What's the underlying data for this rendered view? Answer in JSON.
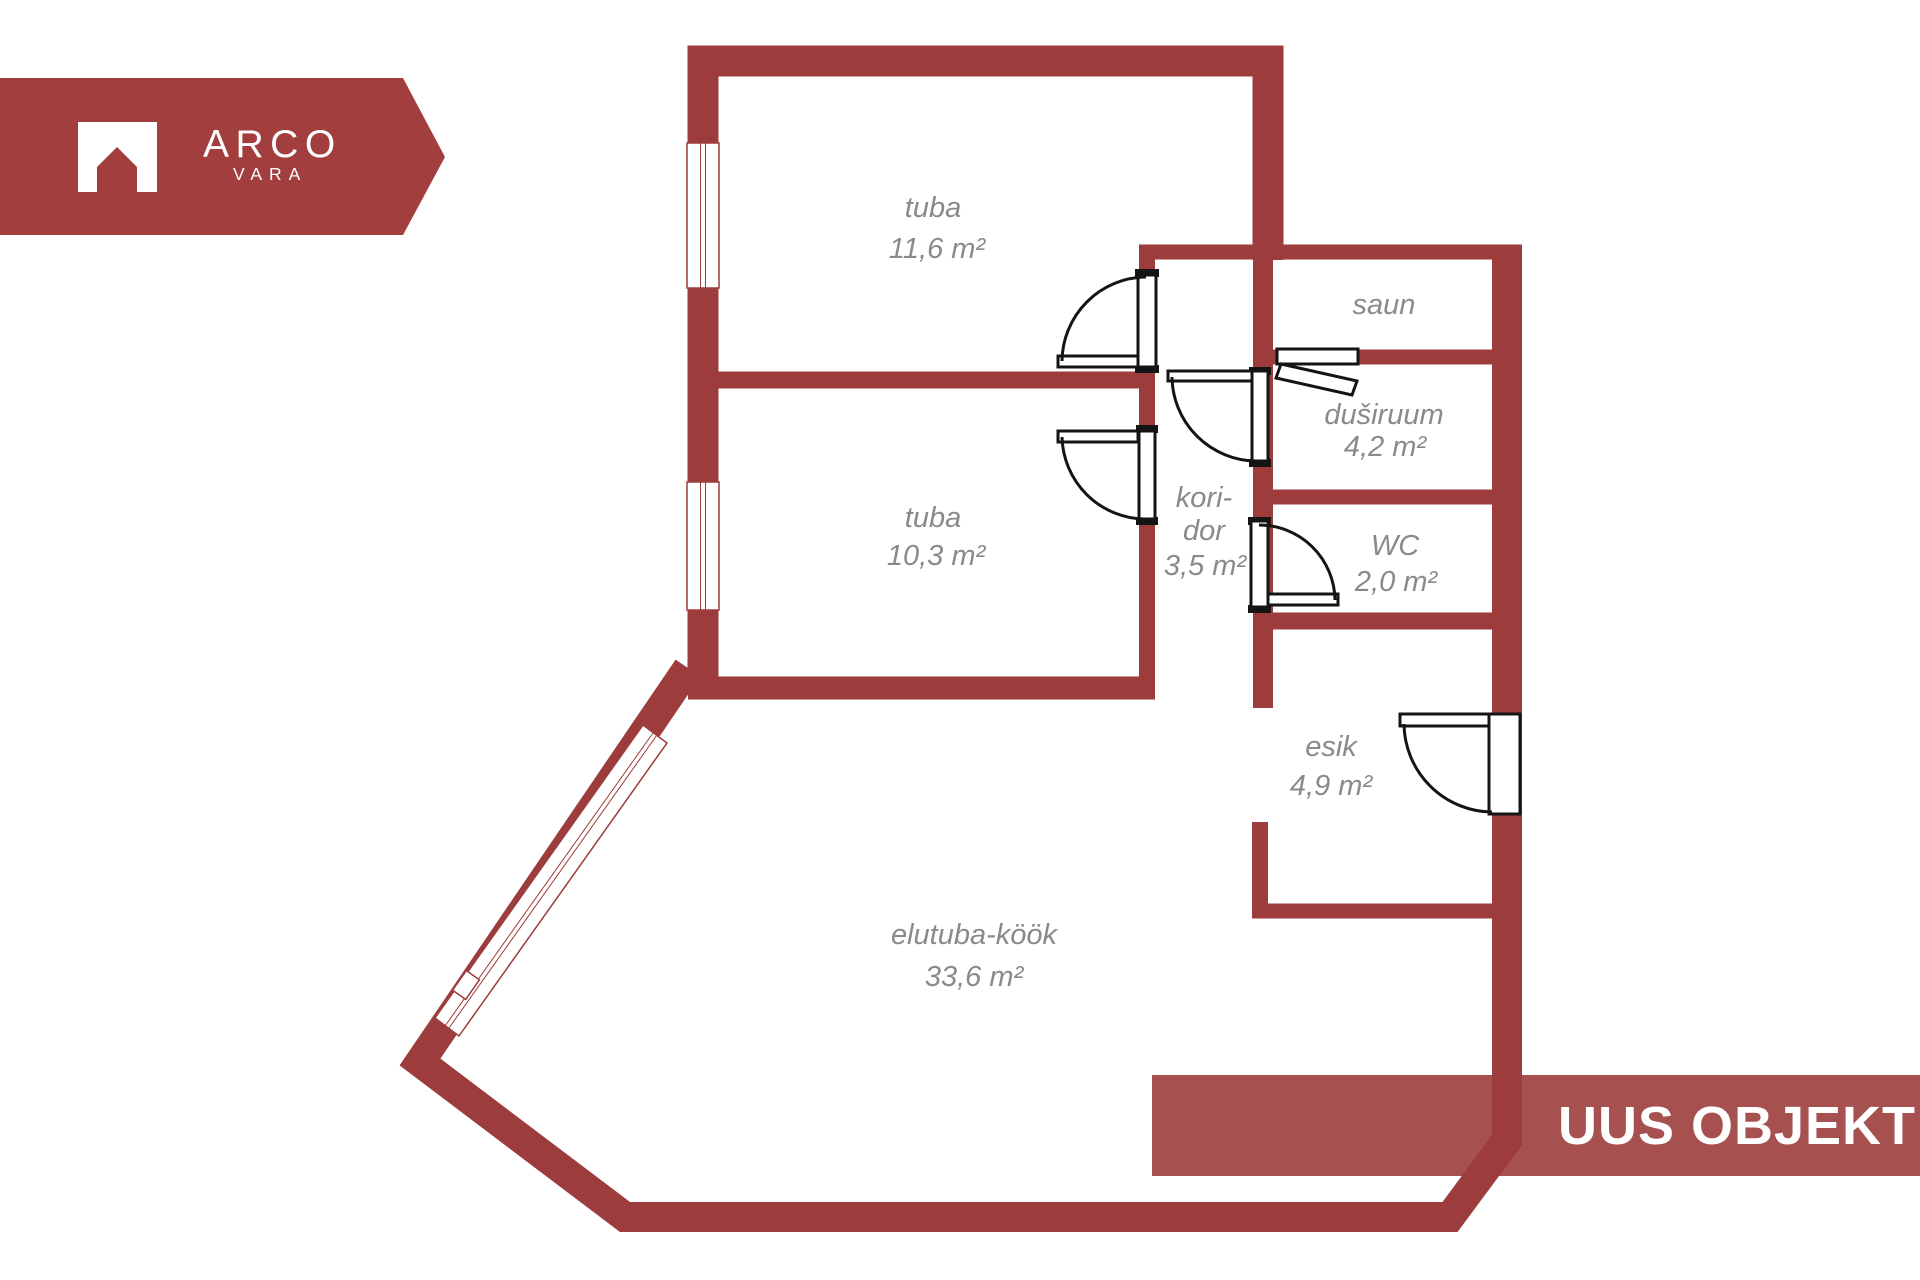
{
  "logo": {
    "brand": "ARCO",
    "sub": "VARA",
    "icon": "house-arch-icon"
  },
  "banner": {
    "text": "UUS OBJEKT"
  },
  "rooms": [
    {
      "name": "tuba",
      "area": "11,6 m²"
    },
    {
      "name": "tuba",
      "area": "10,3 m²"
    },
    {
      "name": "saun",
      "area": ""
    },
    {
      "name": "duširuum",
      "area": "4,2 m²"
    },
    {
      "name": "kori-",
      "name2": "dor",
      "area": "3,5 m²"
    },
    {
      "name": "WC",
      "area": "2,0 m²"
    },
    {
      "name": "esik",
      "area": "4,9 m²"
    },
    {
      "name": "elutuba-köök",
      "area": "33,6 m²"
    }
  ],
  "colors": {
    "wall": "#9C3C3C",
    "object_banner": "#A75050",
    "logo_background": "#A33E3E",
    "label_text": "#8A8A8A",
    "door_lines": "#141414",
    "background": "#FFFFFF"
  }
}
